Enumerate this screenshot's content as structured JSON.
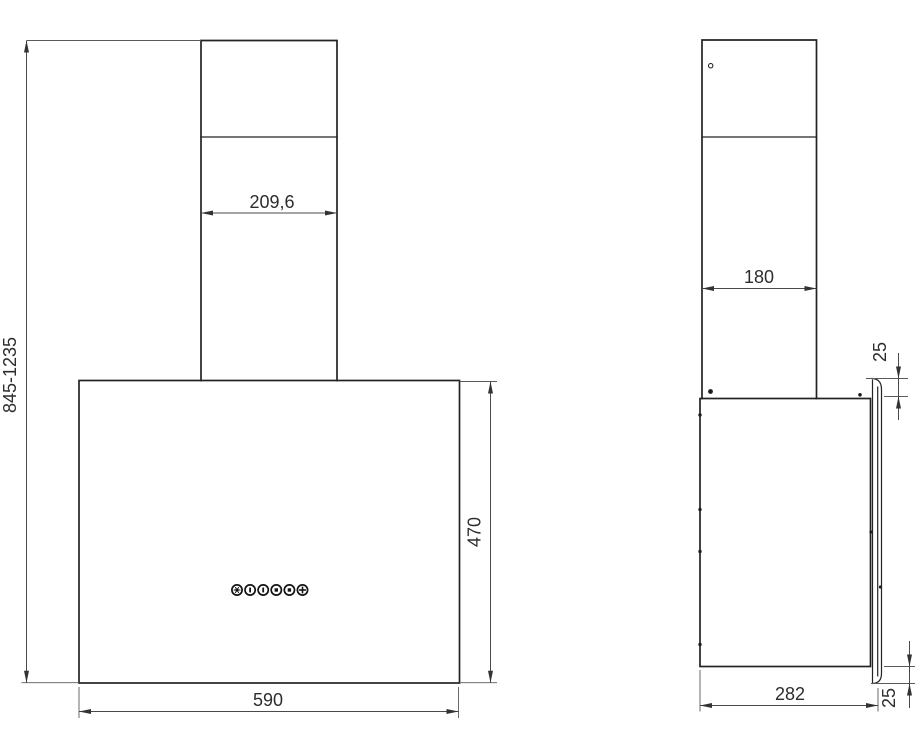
{
  "drawing": {
    "description": "cooker-hood-technical-drawing",
    "colors": {
      "background": "#ffffff",
      "outline": "#232323",
      "dimension_lines": "#4a4a4a",
      "dimension_text": "#2d2d2d"
    },
    "front_view": {
      "dim_chimney_width": "209,6",
      "dim_total_height_range": "845-1235",
      "dim_body_height": "470",
      "dim_body_width": "590",
      "control_buttons": [
        {
          "icon": "light-icon"
        },
        {
          "icon": "speed-1-icon"
        },
        {
          "icon": "speed-2-icon"
        },
        {
          "icon": "speed-3-icon"
        },
        {
          "icon": "speed-4-icon"
        },
        {
          "icon": "timer-icon"
        }
      ]
    },
    "side_view": {
      "dim_chimney_depth": "180",
      "dim_panel_top_offset": "25",
      "dim_body_depth": "282",
      "dim_panel_bottom_offset": "25"
    }
  }
}
